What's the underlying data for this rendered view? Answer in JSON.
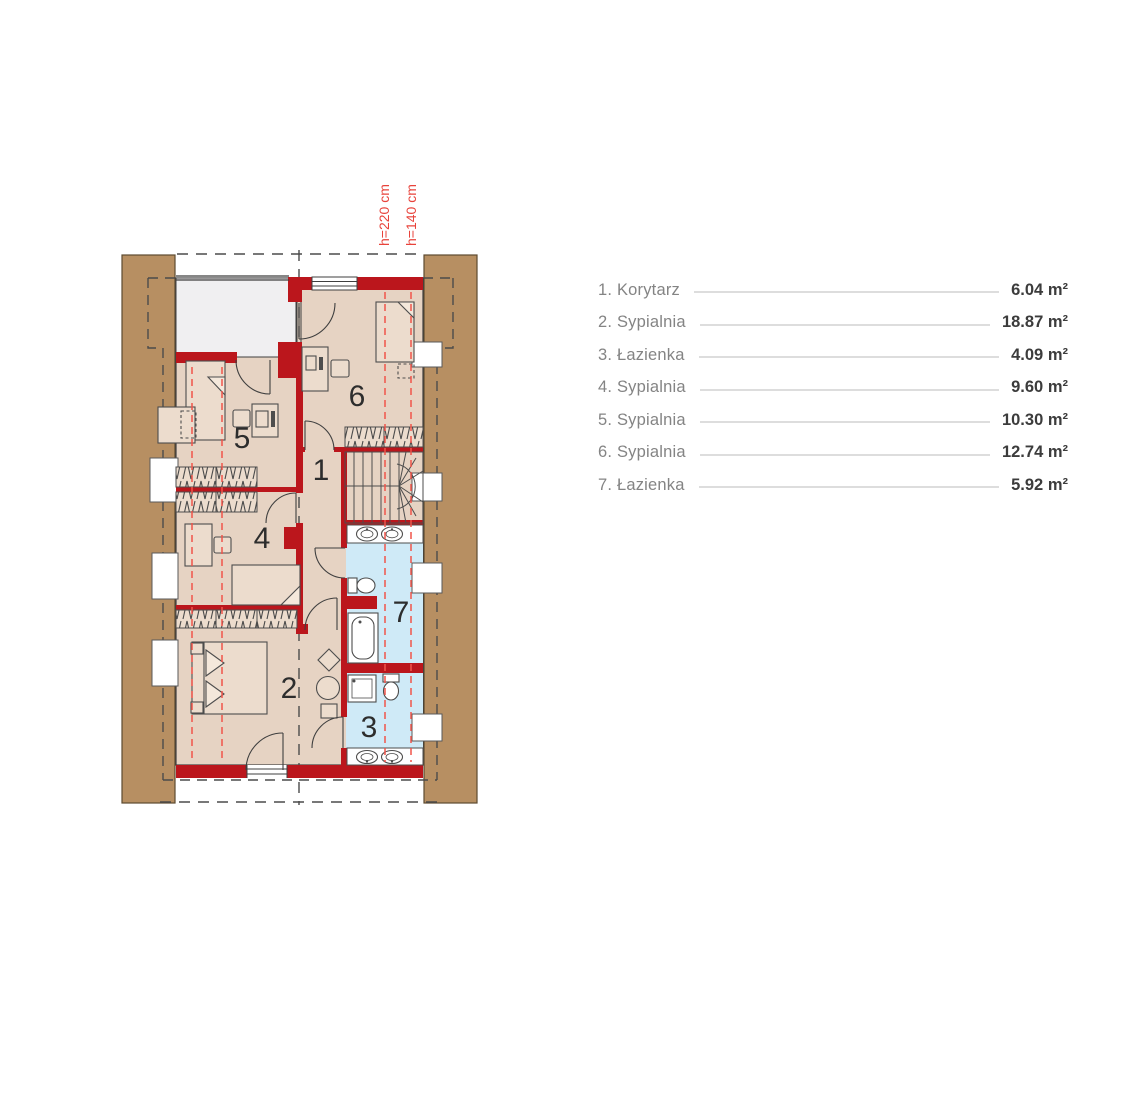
{
  "plan": {
    "title": "attic floor plan",
    "height_labels": [
      {
        "text": "h=220 cm"
      },
      {
        "text": "h=140 cm"
      }
    ],
    "rooms": {
      "r1": "1",
      "r2": "2",
      "r3": "3",
      "r4": "4",
      "r5": "5",
      "r6": "6",
      "r7": "7"
    },
    "colors": {
      "wall_red": "#bb161c",
      "floor_beige": "#e6d3c3",
      "bath_blue": "#cfeaf7",
      "wood_brown": "#b78f62",
      "height_line_red": "#f0544a",
      "outline_dark": "#3f3f3f"
    }
  },
  "legend": {
    "items": [
      {
        "label": "1. Korytarz",
        "area": "6.04 m²"
      },
      {
        "label": "2. Sypialnia",
        "area": "18.87 m²"
      },
      {
        "label": "3. Łazienka",
        "area": "4.09 m²"
      },
      {
        "label": "4. Sypialnia",
        "area": "9.60 m²"
      },
      {
        "label": "5. Sypialnia",
        "area": "10.30 m²"
      },
      {
        "label": "6. Sypialnia",
        "area": "12.74 m²"
      },
      {
        "label": "7. Łazienka",
        "area": "5.92 m²"
      }
    ]
  }
}
